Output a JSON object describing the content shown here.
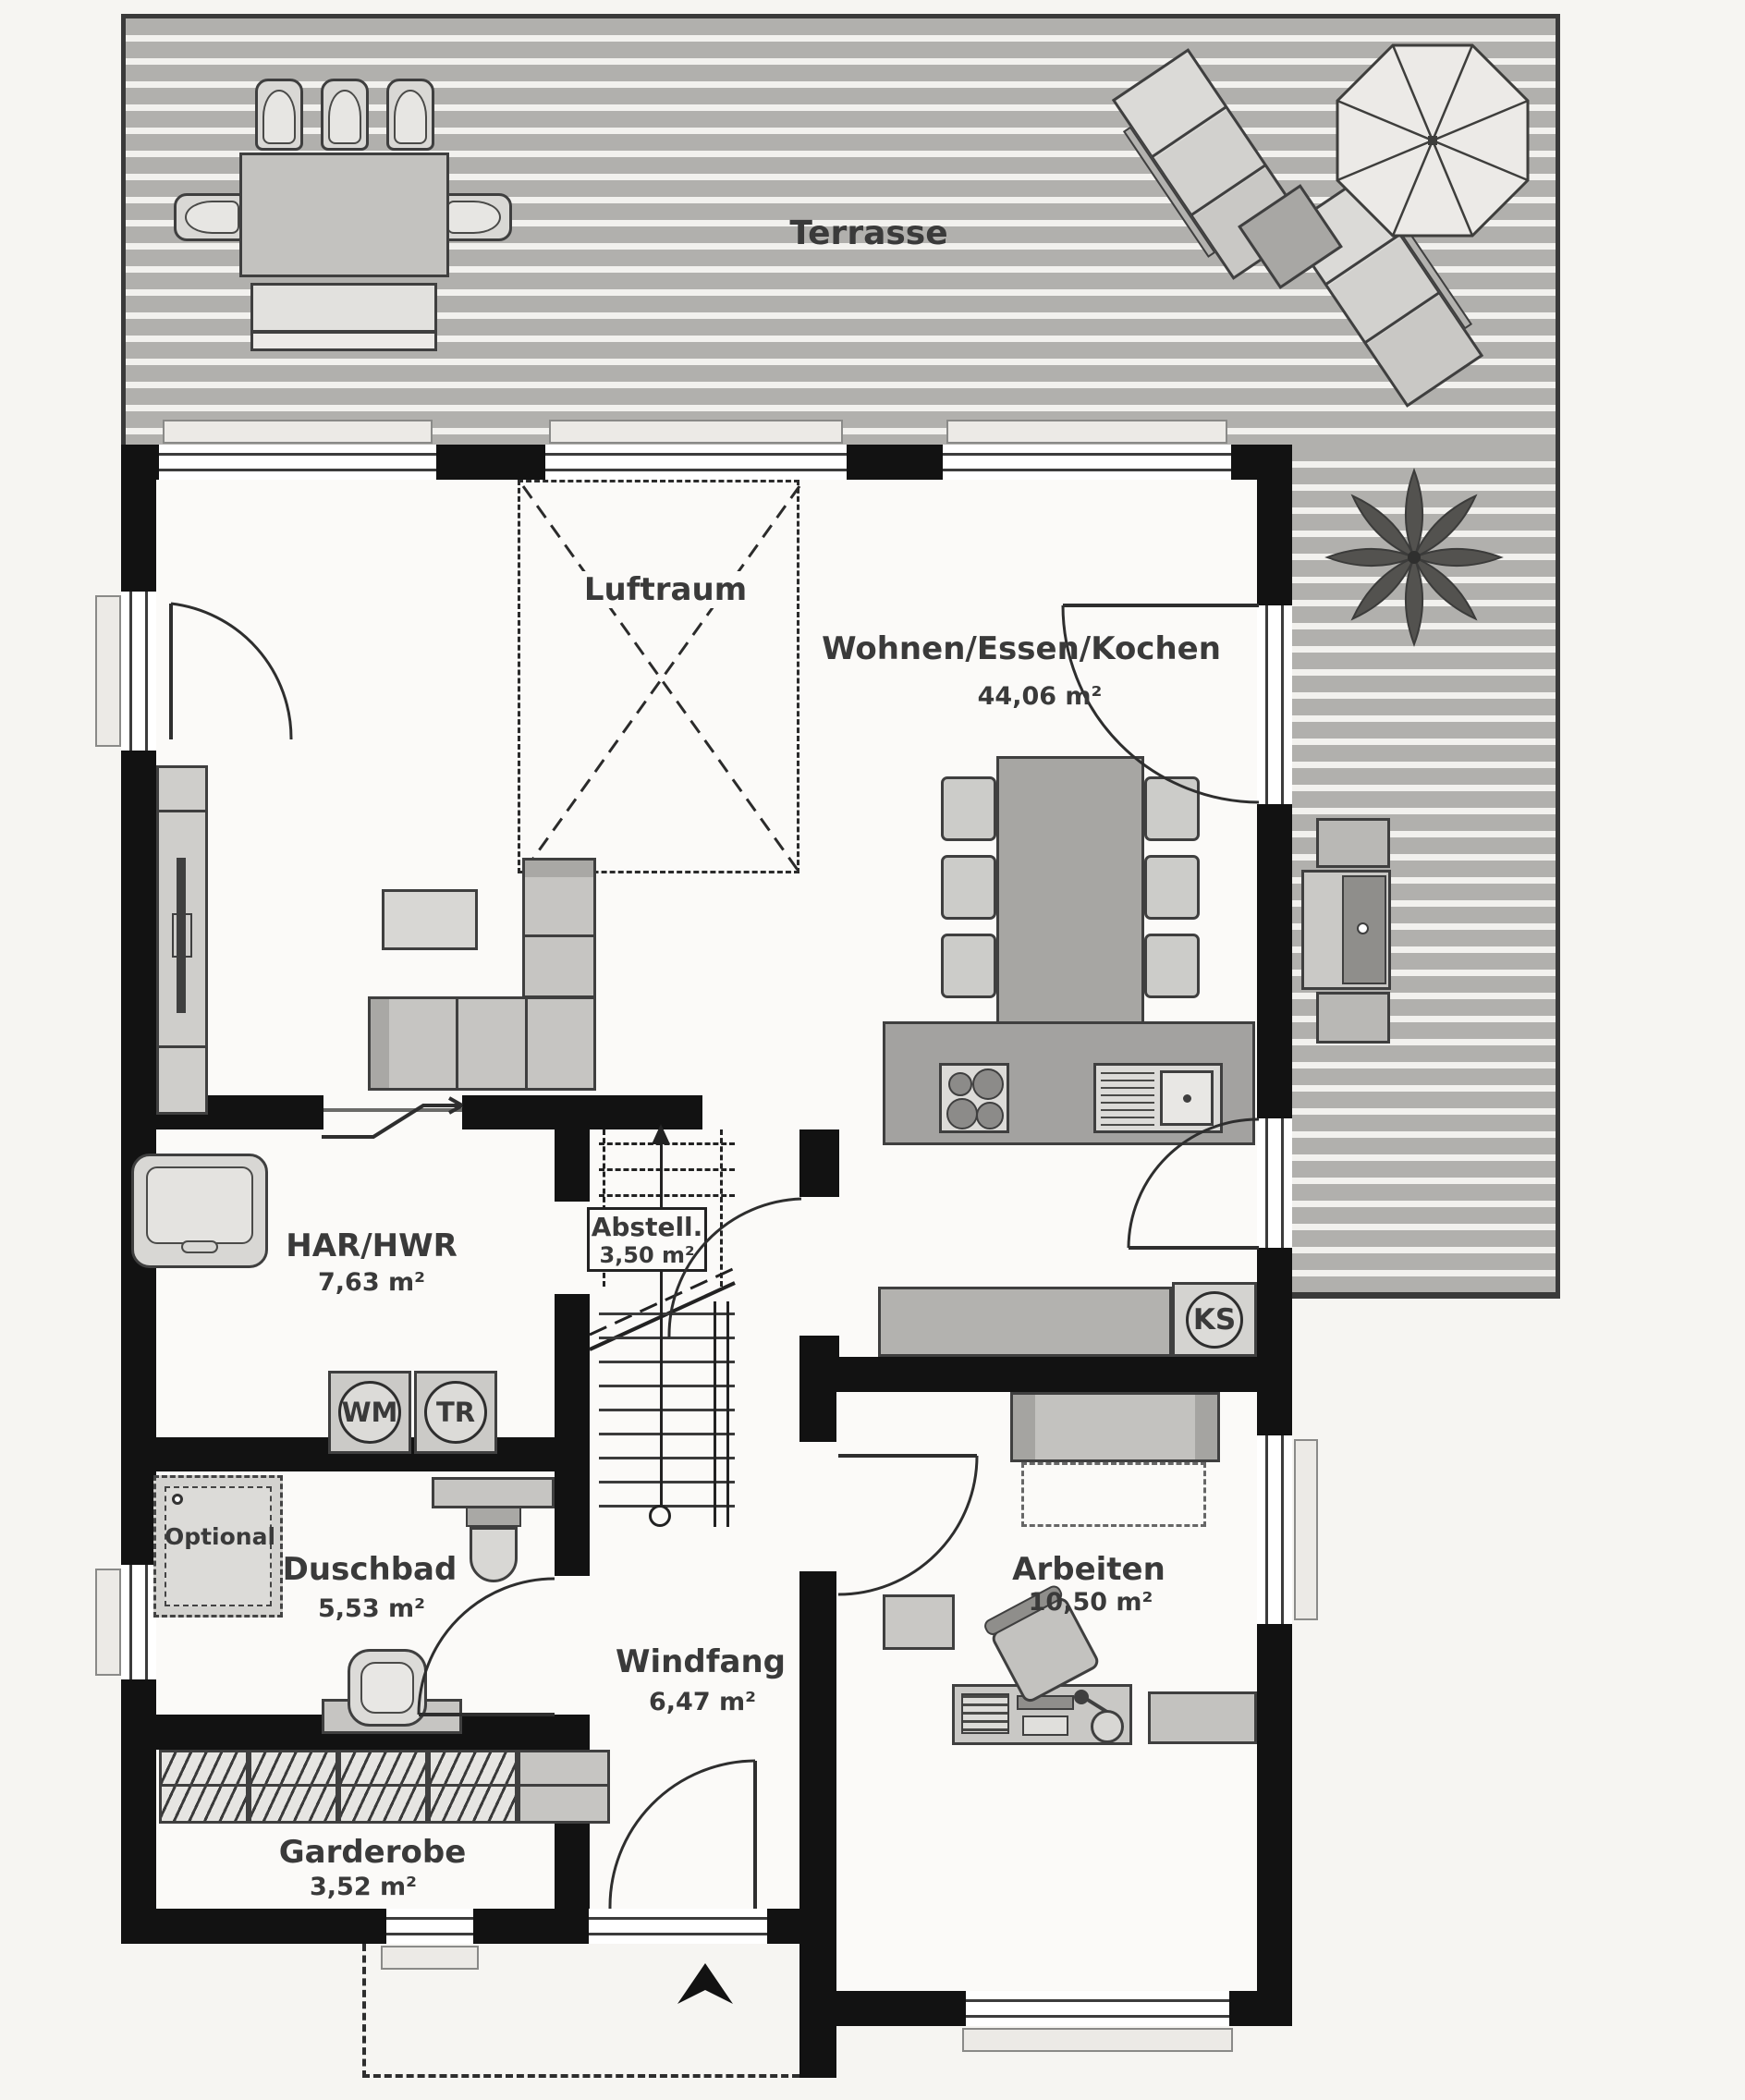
{
  "labels": {
    "terrasse": "Terrasse",
    "luftraum": "Luftraum",
    "optional": "Optional"
  },
  "rooms": {
    "wohnen": {
      "name": "Wohnen/Essen/Kochen",
      "area": "44,06 m²"
    },
    "har": {
      "name": "HAR/HWR",
      "area": "7,63 m²"
    },
    "abstell": {
      "name": "Abstell.",
      "area": "3,50 m²"
    },
    "duschbad": {
      "name": "Duschbad",
      "area": "5,53 m²"
    },
    "windfang": {
      "name": "Windfang",
      "area": "6,47 m²"
    },
    "arbeiten": {
      "name": "Arbeiten",
      "area": "10,50 m²"
    },
    "garderobe": {
      "name": "Garderobe",
      "area": "3,52 m²"
    }
  },
  "appliances": {
    "wm": "WM",
    "tr": "TR",
    "ks": "KS"
  },
  "colors": {
    "wall": "#121212",
    "deck_plank": "#b1b0ad",
    "deck_gap": "#f2f1ee",
    "floor": "#fbfaf8",
    "furniture_light": "#d8d7d4",
    "furniture_mid": "#b3b2af",
    "outline": "#3f3f3f"
  }
}
